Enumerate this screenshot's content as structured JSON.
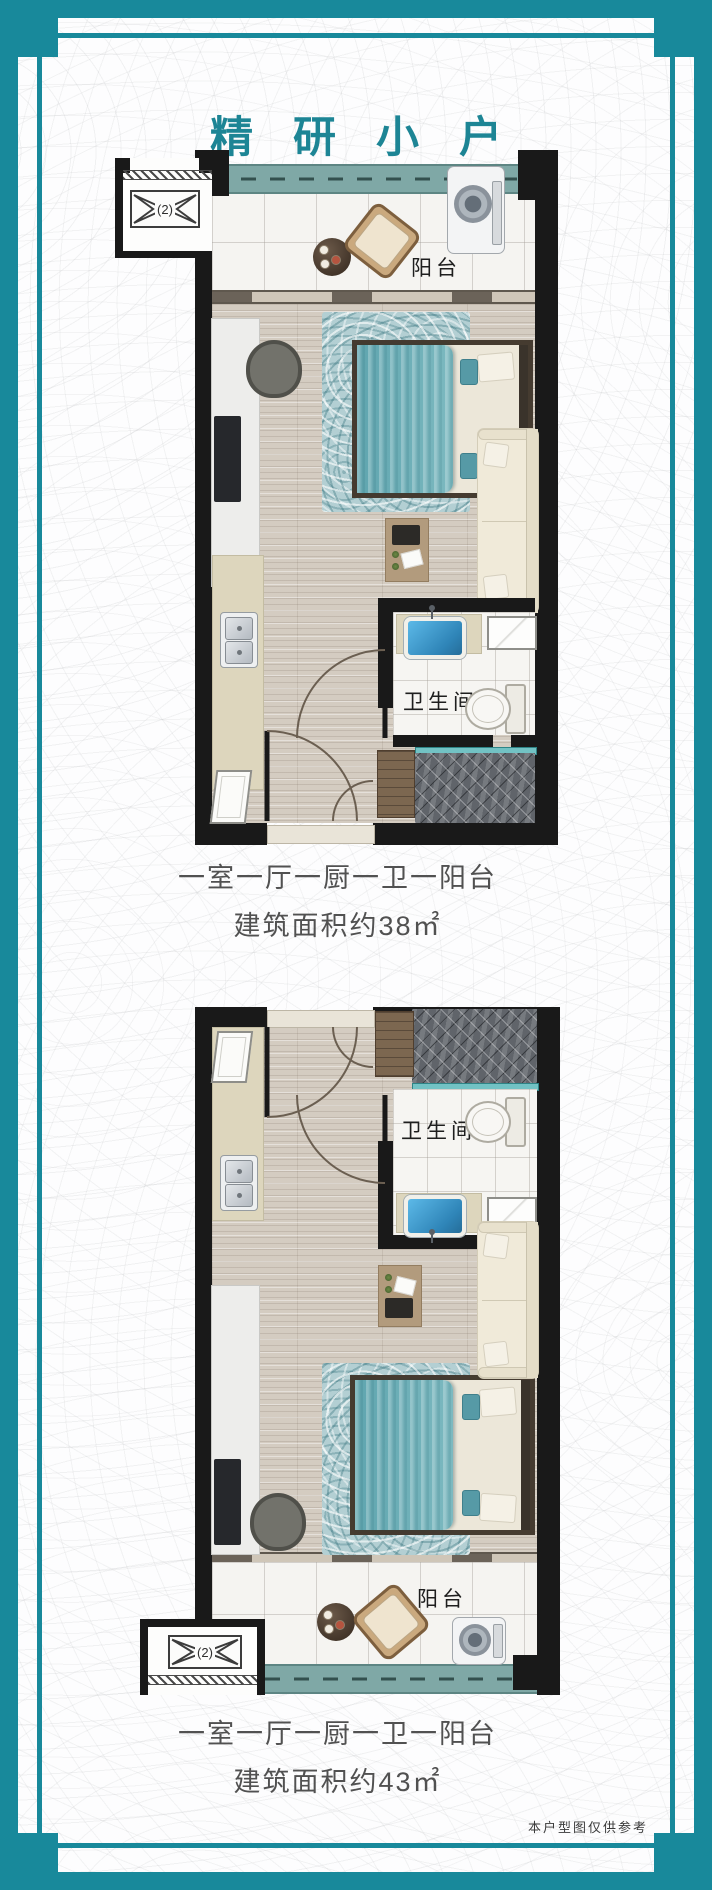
{
  "page": {
    "title": "精研小户",
    "disclaimer": "本户型图仅供参考"
  },
  "plans": [
    {
      "balcony": "阳台",
      "bathroom": "卫生间",
      "ac": "(2)",
      "rooms": "一室一厅一厨一卫一阳台",
      "area": "建筑面积约38㎡"
    },
    {
      "balcony": "阳台",
      "bathroom": "卫生间",
      "ac": "(2)",
      "rooms": "一室一厅一厨一卫一阳台",
      "area": "建筑面积约43㎡"
    }
  ],
  "colors": {
    "frame_teal": "#18899b",
    "title_teal": "#1d8595",
    "caption_gray": "#515151",
    "wall_black": "#191919",
    "bed_teal": "#6fb0b8",
    "window_teal": "#7fa8a6",
    "basin_blue": "#3f9fd8"
  }
}
